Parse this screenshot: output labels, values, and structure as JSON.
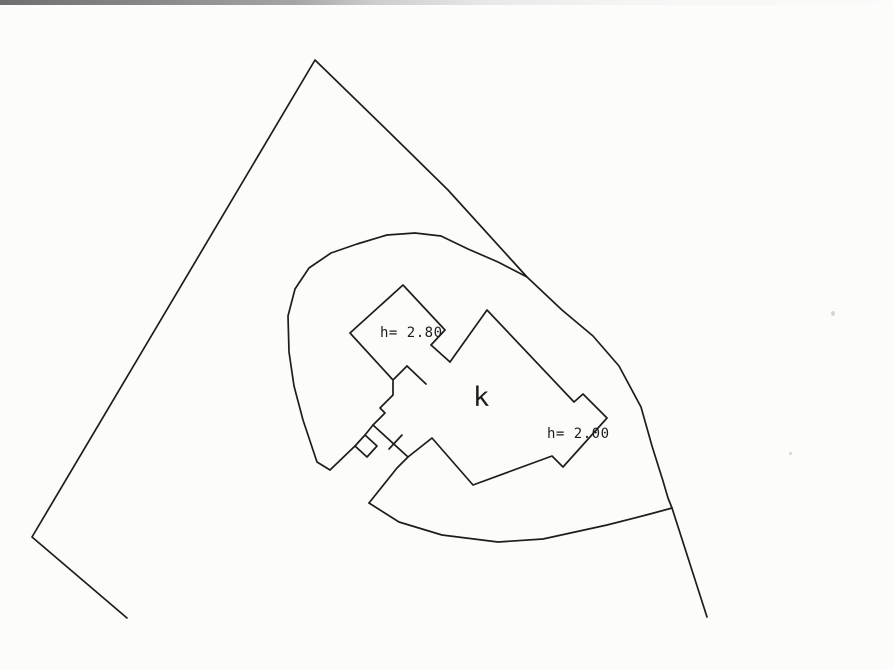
{
  "page": {
    "background_color": "#fcfcfb",
    "scan_artifact_colors": [
      "#6f6f6f",
      "#a5a5a5",
      "#e9e9e9"
    ]
  },
  "drawing": {
    "ink_color": "#1d1d1d",
    "stroke_width": 1.7,
    "labels": {
      "building": "k",
      "height_nw": "h= 2.80",
      "height_east": "h= 2.00"
    },
    "paths": [
      {
        "name": "parcel-boundary",
        "points": [
          [
            127,
            618
          ],
          [
            32,
            537
          ],
          [
            315,
            60
          ],
          [
            390,
            133
          ],
          [
            448,
            190
          ],
          [
            527,
            277
          ],
          [
            562,
            310
          ],
          [
            593,
            336
          ],
          [
            619,
            366
          ],
          [
            641,
            407
          ],
          [
            652,
            446
          ],
          [
            663,
            481
          ],
          [
            668,
            498
          ],
          [
            672,
            508
          ],
          [
            707,
            617
          ]
        ]
      },
      {
        "name": "enclosure-curve-upper",
        "points": [
          [
            527,
            277
          ],
          [
            498,
            262
          ],
          [
            468,
            249
          ],
          [
            441,
            236
          ],
          [
            415,
            233
          ],
          [
            387,
            235
          ],
          [
            357,
            244
          ],
          [
            331,
            253
          ],
          [
            309,
            268
          ],
          [
            295,
            289
          ],
          [
            288,
            316
          ],
          [
            289,
            352
          ],
          [
            294,
            386
          ],
          [
            303,
            420
          ],
          [
            312,
            447
          ],
          [
            317,
            462
          ],
          [
            330,
            470
          ],
          [
            355,
            446
          ]
        ]
      },
      {
        "name": "enclosure-curve-lower",
        "points": [
          [
            369,
            503
          ],
          [
            399,
            522
          ],
          [
            442,
            535
          ],
          [
            498,
            542
          ],
          [
            543,
            539
          ],
          [
            607,
            525
          ],
          [
            650,
            514
          ],
          [
            672,
            508
          ]
        ]
      },
      {
        "name": "building-nw-wing",
        "points": [
          [
            431,
            345
          ],
          [
            445,
            330
          ],
          [
            403,
            285
          ],
          [
            350,
            333
          ],
          [
            393,
            380
          ],
          [
            407,
            366
          ]
        ]
      },
      {
        "name": "building-corridor-upper-wall",
        "points": [
          [
            431,
            345
          ],
          [
            450,
            362
          ]
        ]
      },
      {
        "name": "building-corridor-lower-wall",
        "points": [
          [
            407,
            366
          ],
          [
            426,
            384
          ]
        ]
      },
      {
        "name": "building-main-outline",
        "points": [
          [
            450,
            362
          ],
          [
            487,
            310
          ],
          [
            574,
            402
          ],
          [
            583,
            394
          ],
          [
            607,
            418
          ],
          [
            563,
            467
          ],
          [
            552,
            456
          ],
          [
            473,
            485
          ],
          [
            432,
            438
          ],
          [
            408,
            457
          ],
          [
            397,
            468
          ],
          [
            369,
            503
          ]
        ]
      },
      {
        "name": "building-neck-staircase",
        "points": [
          [
            393,
            381
          ],
          [
            393,
            395
          ],
          [
            380,
            408
          ],
          [
            385,
            413
          ],
          [
            373,
            425
          ],
          [
            365,
            435
          ]
        ]
      },
      {
        "name": "building-diamond-bump",
        "points": [
          [
            365,
            435
          ],
          [
            377,
            446
          ],
          [
            367,
            457
          ],
          [
            355,
            446
          ],
          [
            365,
            435
          ]
        ]
      },
      {
        "name": "building-neck-line",
        "points": [
          [
            373,
            425
          ],
          [
            408,
            457
          ]
        ]
      },
      {
        "name": "survey-tick",
        "points": [
          [
            402,
            435
          ],
          [
            389,
            449
          ]
        ]
      }
    ]
  }
}
